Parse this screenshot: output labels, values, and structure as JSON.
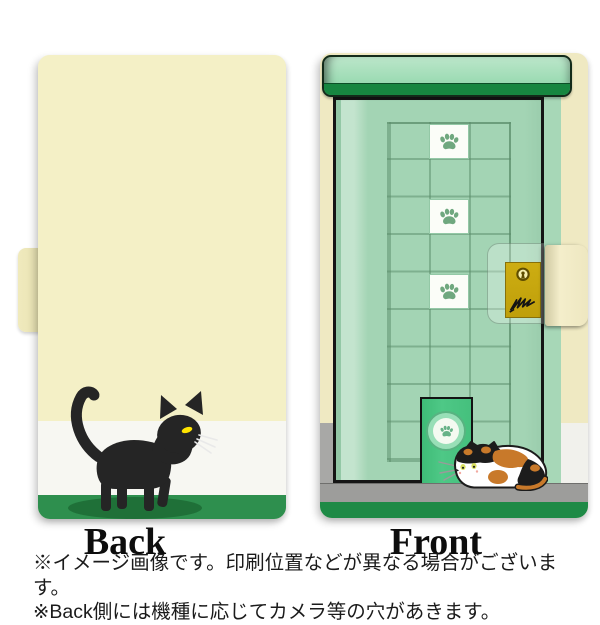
{
  "back_panel": {
    "label": "Back",
    "colors": {
      "cover_cream": "#f4f0c6",
      "stripe_white": "#f7f7f2",
      "ground_green": "#2e8f4e",
      "cat_black": "#252525",
      "cat_eye_yellow": "#ffe400",
      "cat_shadow_green": "#1f7038"
    }
  },
  "front_panel": {
    "label": "Front",
    "paw_tile_count": 3,
    "icons": [
      "paw-print-icon",
      "keyhole-icon",
      "scratch-marks-icon"
    ],
    "colors": {
      "door_mint": "#a3d4b4",
      "lintel_mint": "#9edcb5",
      "lintel_band_green": "#178640",
      "pet_door_green": "#49c580",
      "lock_plate_gold": "#c4a40e",
      "floor_gray": "#9d9d9b",
      "bottom_edge_green": "#1e8a46",
      "spine_cream": "#efe9c2",
      "calico_orange": "#c8792a"
    }
  },
  "notes": {
    "line1": "※イメージ画像です。印刷位置などが異なる場合がございます。",
    "line2": "※Back側には機種に応じてカメラ等の穴があきます。"
  }
}
